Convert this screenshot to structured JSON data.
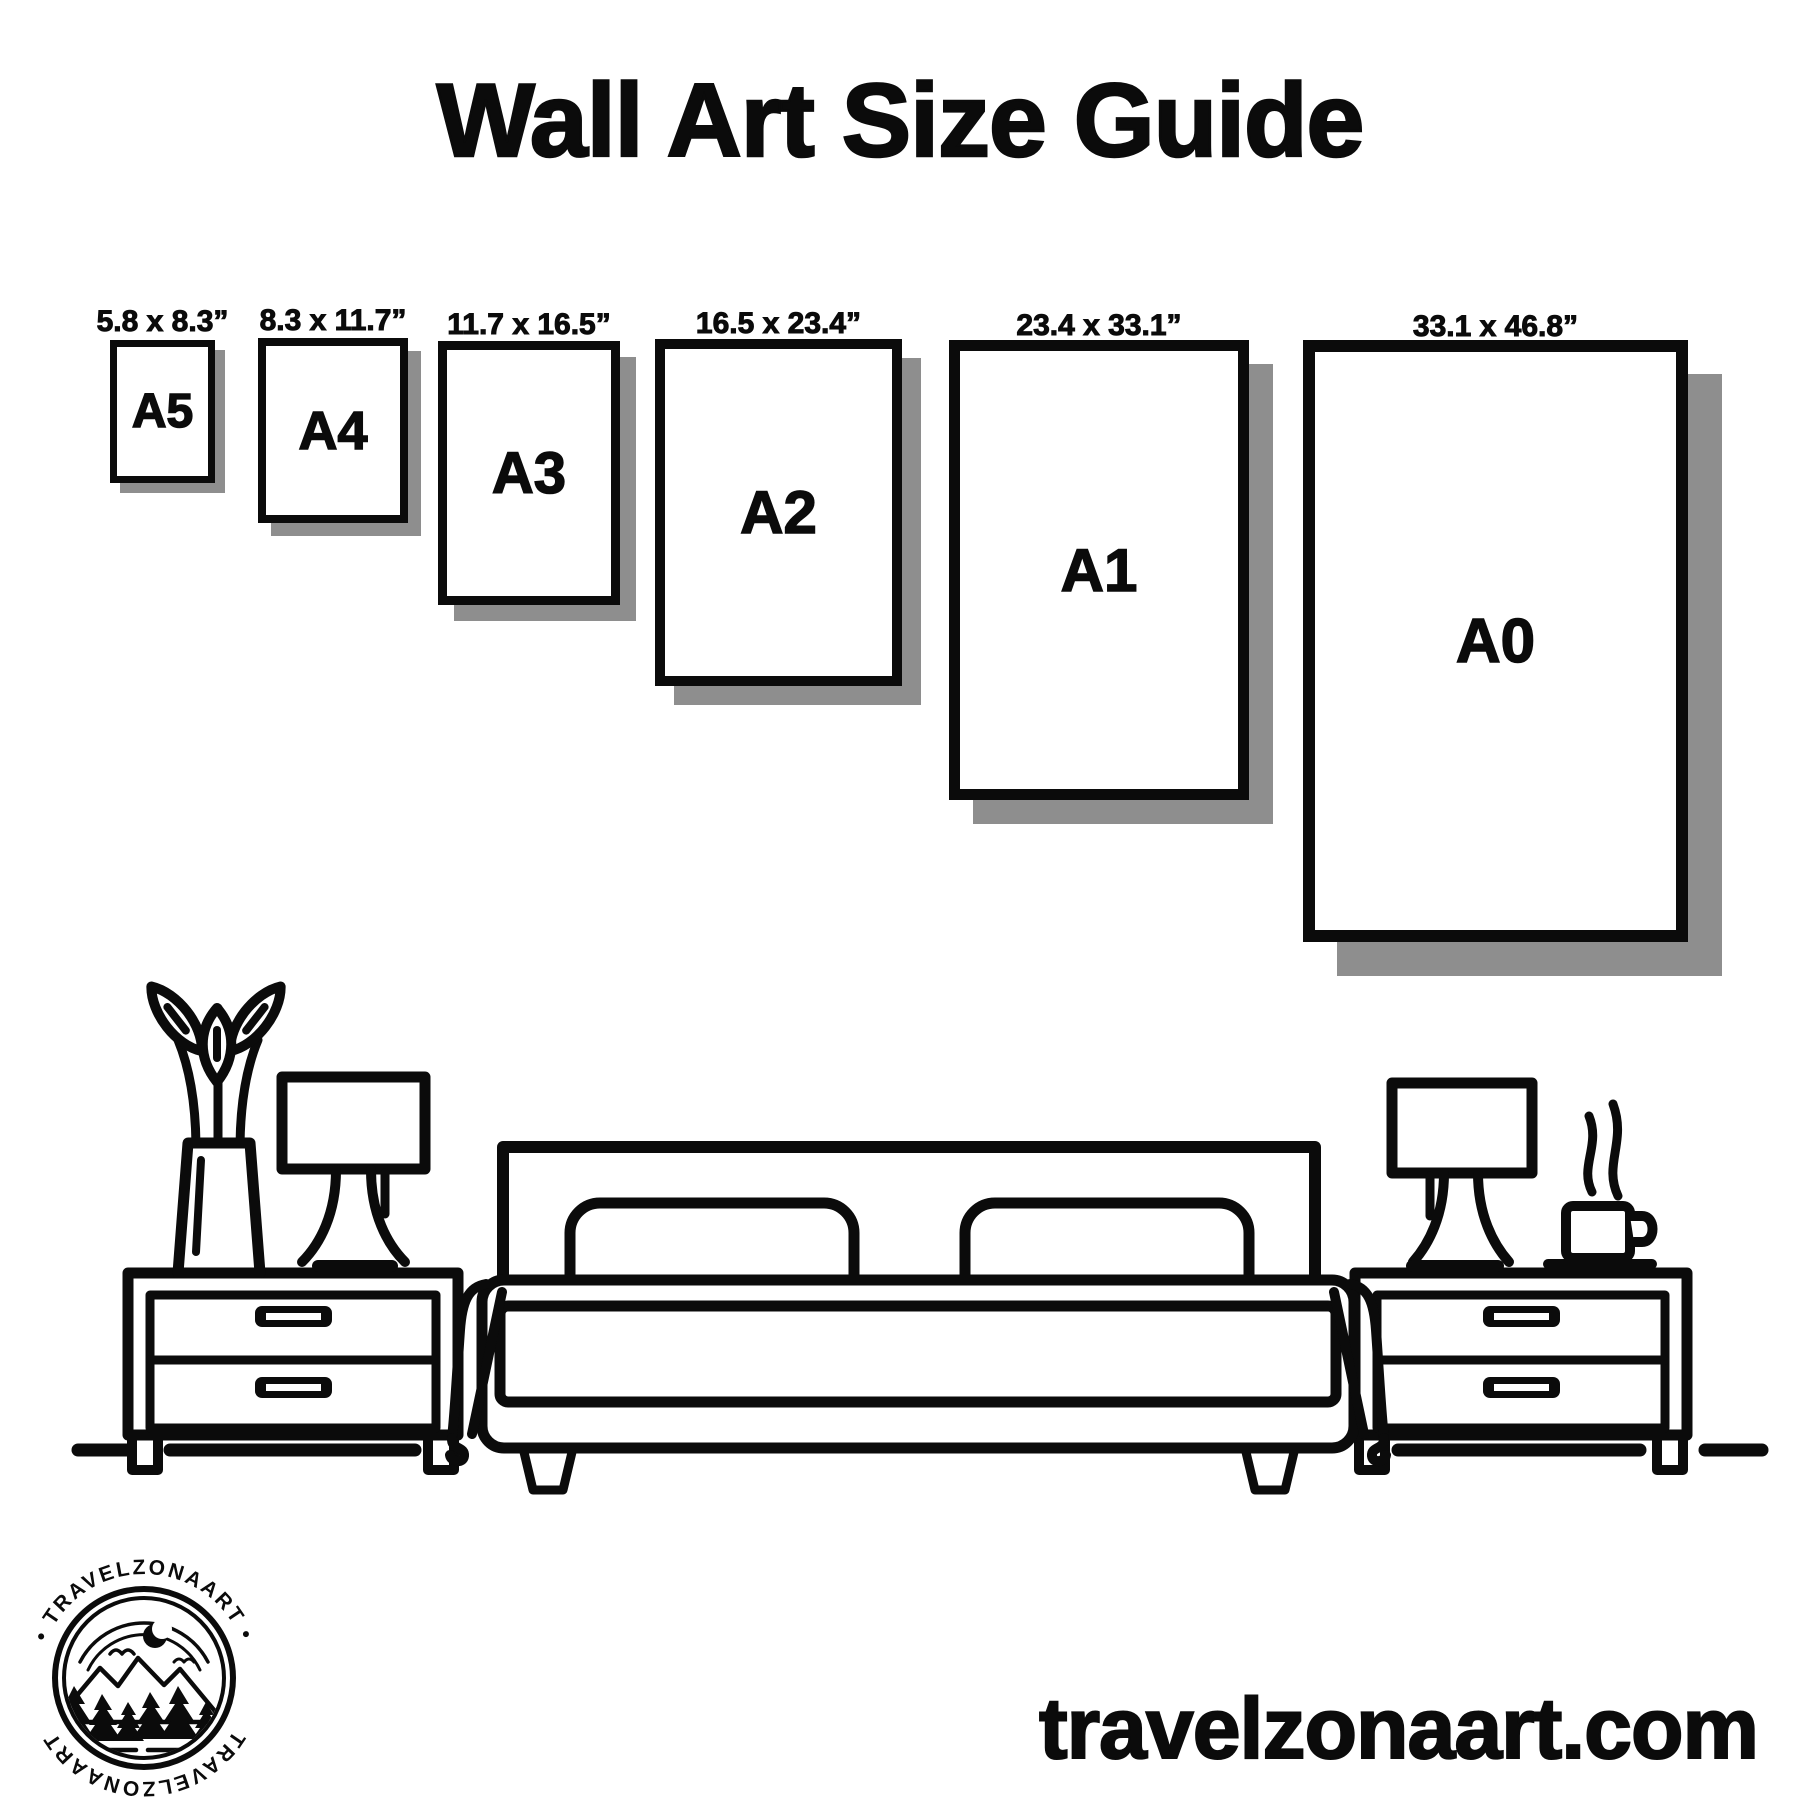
{
  "title": "Wall Art Size Guide",
  "papers": [
    {
      "id": "a5",
      "name": "A5",
      "dimensions": "5.8 x 8.3”"
    },
    {
      "id": "a4",
      "name": "A4",
      "dimensions": "8.3 x 11.7”"
    },
    {
      "id": "a3",
      "name": "A3",
      "dimensions": "11.7 x 16.5”"
    },
    {
      "id": "a2",
      "name": "A2",
      "dimensions": "16.5 x 23.4”"
    },
    {
      "id": "a1",
      "name": "A1",
      "dimensions": "23.4 x 33.1”"
    },
    {
      "id": "a0",
      "name": "A0",
      "dimensions": "33.1 x 46.8”"
    }
  ],
  "footer": {
    "website": "travelzonaart.com",
    "logo": {
      "arc_top": "• TRAVELZONAART •",
      "arc_bottom": "TRAVELZONAART"
    }
  },
  "colors": {
    "ink": "#0b0b0b",
    "shadow": "#8e8e8e",
    "background": "#ffffff"
  }
}
